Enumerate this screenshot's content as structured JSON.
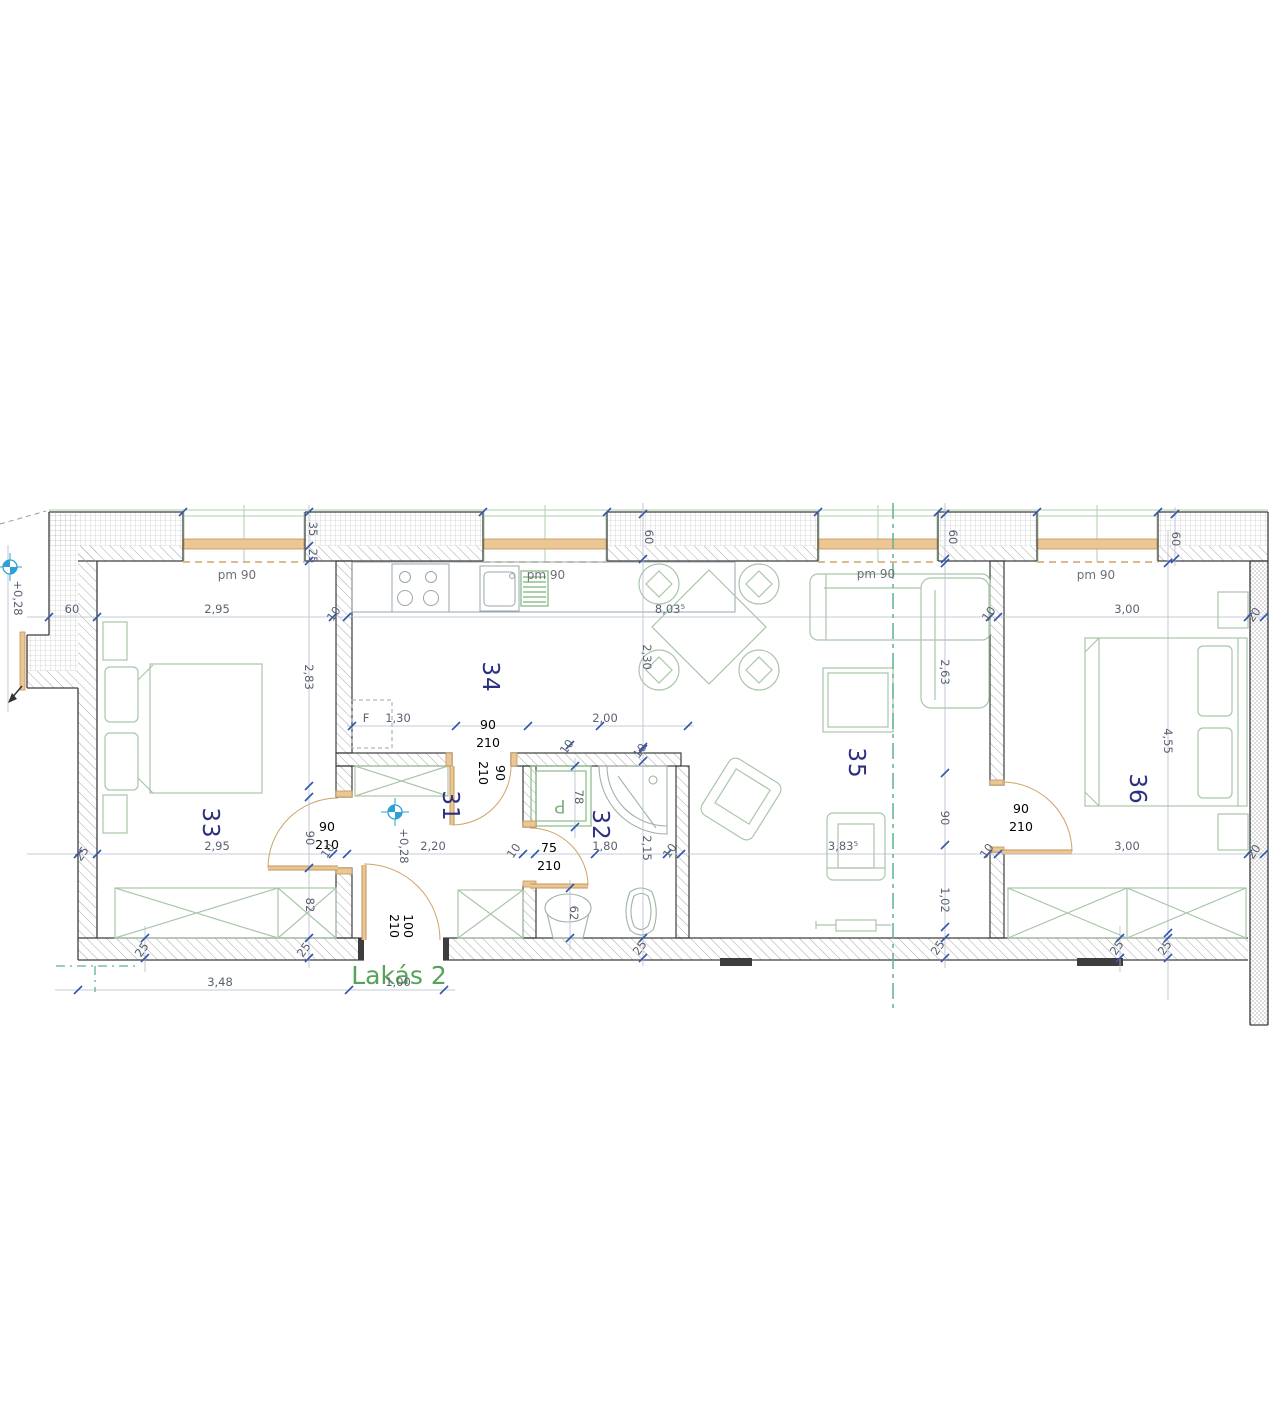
{
  "drawing_title": "Lakás 2",
  "colors": {
    "wall-line": "#3d3d3d",
    "dim-line": "#b4bdca",
    "dim-text": "#5a6170",
    "tick": "#3456ae",
    "room-text": "#2b2f7e",
    "furniture": "#a9c6a9",
    "fixture": "#9fb3a6",
    "wood-fill": "#ecc793",
    "wood-stroke": "#bf945b",
    "door-arc": "#cfa365",
    "green-line": "#aecfae",
    "section-green": "#5fb292",
    "title-green": "#55a259",
    "level-blue": "#2da0d6"
  },
  "labels": {
    "apartment": [
      {
        "text": "Lakás 2",
        "x": 399,
        "y": 984
      }
    ],
    "rooms": [
      {
        "text": "33",
        "x": 203,
        "y": 823,
        "rot": 90
      },
      {
        "text": "34",
        "x": 483,
        "y": 677,
        "rot": 90
      },
      {
        "text": "31",
        "x": 443,
        "y": 806,
        "rot": 90
      },
      {
        "text": "32",
        "x": 593,
        "y": 825,
        "rot": 90
      },
      {
        "text": "35",
        "x": 849,
        "y": 763,
        "rot": 90
      },
      {
        "text": "36",
        "x": 1130,
        "y": 789,
        "rot": 90
      }
    ],
    "windows": [
      {
        "text": "pm 90",
        "x": 237,
        "y": 579
      },
      {
        "text": "pm 90",
        "x": 546,
        "y": 579
      },
      {
        "text": "pm 90",
        "x": 876,
        "y": 578
      },
      {
        "text": "pm 90",
        "x": 1096,
        "y": 579
      }
    ],
    "door_sizes": [
      {
        "text": "90",
        "x": 327,
        "y": 831
      },
      {
        "text": "210",
        "x": 327,
        "y": 849
      },
      {
        "text": "75",
        "x": 549,
        "y": 852
      },
      {
        "text": "210",
        "x": 549,
        "y": 870
      },
      {
        "text": "90",
        "x": 1021,
        "y": 813
      },
      {
        "text": "210",
        "x": 1021,
        "y": 831
      },
      {
        "text": "90",
        "x": 488,
        "y": 729
      },
      {
        "text": "210",
        "x": 488,
        "y": 747
      },
      {
        "text": "210",
        "x": 479,
        "y": 773,
        "rot": 90
      },
      {
        "text": "90",
        "x": 496,
        "y": 773,
        "rot": 90
      },
      {
        "text": "210",
        "x": 390,
        "y": 926,
        "rot": 90
      },
      {
        "text": "100",
        "x": 404,
        "y": 926,
        "rot": 90
      }
    ],
    "dimensions": [
      {
        "text": "60",
        "x": 72,
        "y": 613
      },
      {
        "text": "2,95",
        "x": 217,
        "y": 613
      },
      {
        "text": "10",
        "x": 337,
        "y": 616,
        "rot": -55
      },
      {
        "text": "8,03⁵",
        "x": 670,
        "y": 613
      },
      {
        "text": "10",
        "x": 992,
        "y": 616,
        "rot": -55
      },
      {
        "text": "3,00",
        "x": 1127,
        "y": 613
      },
      {
        "text": "20",
        "x": 1257,
        "y": 617,
        "rot": -55
      },
      {
        "text": "25",
        "x": 85,
        "y": 856,
        "rot": -55
      },
      {
        "text": "2,95",
        "x": 217,
        "y": 850
      },
      {
        "text": "10",
        "x": 331,
        "y": 853,
        "rot": -55
      },
      {
        "text": "2,20",
        "x": 433,
        "y": 850
      },
      {
        "text": "10",
        "x": 517,
        "y": 853,
        "rot": -55
      },
      {
        "text": "1,80",
        "x": 605,
        "y": 850
      },
      {
        "text": "10",
        "x": 673,
        "y": 853,
        "rot": -55
      },
      {
        "text": "3,83⁵",
        "x": 843,
        "y": 850
      },
      {
        "text": "10",
        "x": 990,
        "y": 853,
        "rot": -55
      },
      {
        "text": "3,00",
        "x": 1127,
        "y": 850
      },
      {
        "text": "20",
        "x": 1257,
        "y": 854,
        "rot": -55
      },
      {
        "text": "F",
        "x": 366,
        "y": 722
      },
      {
        "text": "1,30",
        "x": 398,
        "y": 722
      },
      {
        "text": "2,00",
        "x": 605,
        "y": 722
      },
      {
        "text": "10",
        "x": 570,
        "y": 749,
        "rot": -55
      },
      {
        "text": "10",
        "x": 643,
        "y": 753,
        "rot": -55
      },
      {
        "text": "3,48",
        "x": 220,
        "y": 986
      },
      {
        "text": "1,00",
        "x": 398,
        "y": 986
      },
      {
        "text": "2,83",
        "x": 305,
        "y": 677,
        "rot": 90
      },
      {
        "text": "2,30",
        "x": 643,
        "y": 657,
        "rot": 90
      },
      {
        "text": "2,15",
        "x": 643,
        "y": 848,
        "rot": 90
      },
      {
        "text": "2,63",
        "x": 941,
        "y": 672,
        "rot": 90
      },
      {
        "text": "90",
        "x": 941,
        "y": 818,
        "rot": 90
      },
      {
        "text": "1,02",
        "x": 941,
        "y": 900,
        "rot": 90
      },
      {
        "text": "4,55",
        "x": 1164,
        "y": 741,
        "rot": 90
      },
      {
        "text": "90",
        "x": 306,
        "y": 838,
        "rot": 90
      },
      {
        "text": "82",
        "x": 306,
        "y": 905,
        "rot": 90
      },
      {
        "text": "78",
        "x": 575,
        "y": 797,
        "rot": 90
      },
      {
        "text": "62",
        "x": 570,
        "y": 913,
        "rot": 90
      },
      {
        "text": "35",
        "x": 309,
        "y": 529,
        "rot": 90
      },
      {
        "text": "25",
        "x": 309,
        "y": 556,
        "rot": 90
      },
      {
        "text": "60",
        "x": 645,
        "y": 537,
        "rot": 90
      },
      {
        "text": "60",
        "x": 949,
        "y": 537,
        "rot": 90
      },
      {
        "text": "60",
        "x": 1172,
        "y": 539,
        "rot": 90
      },
      {
        "text": "25",
        "x": 145,
        "y": 952,
        "rot": -55
      },
      {
        "text": "25",
        "x": 307,
        "y": 952,
        "rot": -55
      },
      {
        "text": "25",
        "x": 643,
        "y": 950,
        "rot": -55
      },
      {
        "text": "25",
        "x": 941,
        "y": 950,
        "rot": -55
      },
      {
        "text": "25",
        "x": 1120,
        "y": 950,
        "rot": -55
      },
      {
        "text": "25",
        "x": 1168,
        "y": 950,
        "rot": -55
      }
    ],
    "levels": [
      {
        "text": "+0,28",
        "x": 14,
        "y": 598,
        "rot": 90
      },
      {
        "text": "+0,28",
        "x": 400,
        "y": 846,
        "rot": 90
      }
    ],
    "fixtures": [
      {
        "text": "P",
        "x": 560,
        "y": 800,
        "rot": 180
      }
    ]
  }
}
